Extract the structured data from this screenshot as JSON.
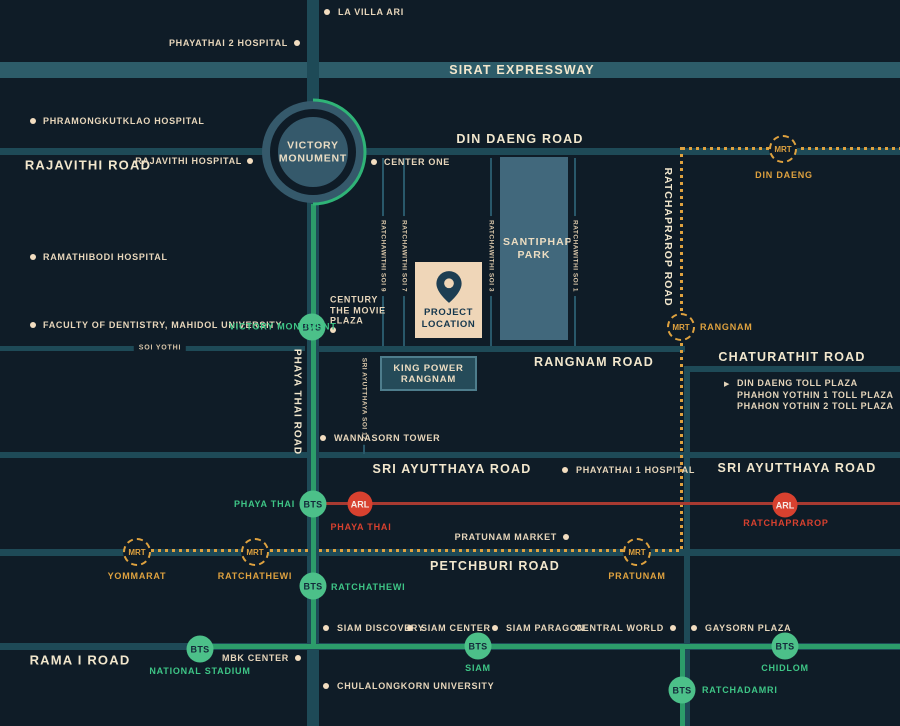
{
  "badges": {
    "bts": "BTS",
    "mrt": "MRT",
    "arl": "ARL"
  },
  "roads": {
    "sirat_expressway": "SIRAT EXPRESSWAY",
    "din_daeng": "DIN DAENG ROAD",
    "rajavithi": "RAJAVITHI ROAD",
    "ratchaprarop": "RATCHAPRAROP ROAD",
    "chaturathit": "CHATURATHIT ROAD",
    "rangnam": "RANGNAM ROAD",
    "phaya_thai": "PHAYA THAI ROAD",
    "soi_yothi": "SOI YOTHI",
    "sri_ayutthaya_west": "SRI AYUTTHAYA ROAD",
    "sri_ayutthaya_east": "SRI AYUTTHAYA ROAD",
    "sri_ayutthaya_soi_12": "SRI AYUTTHAYA SOI 12",
    "petchburi": "PETCHBURI ROAD",
    "rama_i": "RAMA I ROAD",
    "ratchawithi_soi_9": "RATCHAWITHI SOI 9",
    "ratchawithi_soi_7": "RATCHAWITHI SOI 7",
    "ratchawithi_soi_3": "RATCHAWITHI SOI 3",
    "ratchawithi_soi_1": "RATCHAWITHI SOI 1"
  },
  "landmarks": {
    "victory_monument": "VICTORY MONUMENT",
    "santiphap_park": "SANTIPHAP PARK",
    "project_location": "PROJECT LOCATION",
    "king_power_rangnam": "KING POWER RANGNAM"
  },
  "stations": {
    "bts_victory_monument": "VICTORY MONUMENT",
    "bts_phaya_thai": "PHAYA THAI",
    "bts_ratchathewi": "RATCHATHEWI",
    "bts_national_stadium": "NATIONAL STADIUM",
    "bts_siam": "SIAM",
    "bts_chidlom": "CHIDLOM",
    "bts_ratchadamri": "RATCHADAMRI",
    "arl_phaya_thai": "PHAYA THAI",
    "arl_ratchaprarop": "RATCHAPRAROP",
    "mrt_din_daeng": "DIN DAENG",
    "mrt_rangnam": "RANGNAM",
    "mrt_yommarat": "YOMMARAT",
    "mrt_ratchathewi": "RATCHATHEWI",
    "mrt_pratunam": "PRATUNAM"
  },
  "places": {
    "la_villa_ari": "LA VILLA ARI",
    "phayathai_2_hospital": "PHAYATHAI 2 HOSPITAL",
    "phramongkutklao_hospital": "PHRAMONGKUTKLAO HOSPITAL",
    "rajavithi_hospital": "RAJAVITHI HOSPITAL",
    "center_one": "CENTER ONE",
    "ramathibodi_hospital": "RAMATHIBODI HOSPITAL",
    "faculty_of_dentistry": "FACULTY OF DENTISTRY, MAHIDOL UNIVERSITY",
    "century_the_movie_plaza": "CENTURY THE MOVIE PLAZA",
    "wannasorn_tower": "WANNASORN TOWER",
    "phayathai_1_hospital": "PHAYATHAI 1 HOSPITAL",
    "pratunam_market": "PRATUNAM MARKET",
    "mbk_center": "MBK CENTER",
    "siam_discovery": "SIAM DISCOVERY",
    "siam_center": "SIAM CENTER",
    "siam_paragon": "SIAM PARAGON",
    "central_world": "CENTRAL WORLD",
    "gaysorn_plaza": "GAYSORN PLAZA",
    "chulalongkorn_university": "CHULALONGKORN UNIVERSITY"
  },
  "toll_plazas": [
    "DIN DAENG TOLL PLAZA",
    "PHAHON YOTHIN 1 TOLL PLAZA",
    "PHAHON YOTHIN 2 TOLL PLAZA"
  ],
  "colors": {
    "background": "#0f1c27",
    "road_teal": "#1e4a57",
    "expressway_teal": "#2d5c69",
    "park_fill": "#41687c",
    "cream_text": "#e7d6bb",
    "bts_green": "#4cc089",
    "bts_line_green": "#2c9c6a",
    "mrt_orange": "#dfa23f",
    "arl_red": "#d8412f",
    "arl_line_red": "#a83a31",
    "project_box_cream": "#efd6b8",
    "pin_navy": "#1d3e53"
  }
}
